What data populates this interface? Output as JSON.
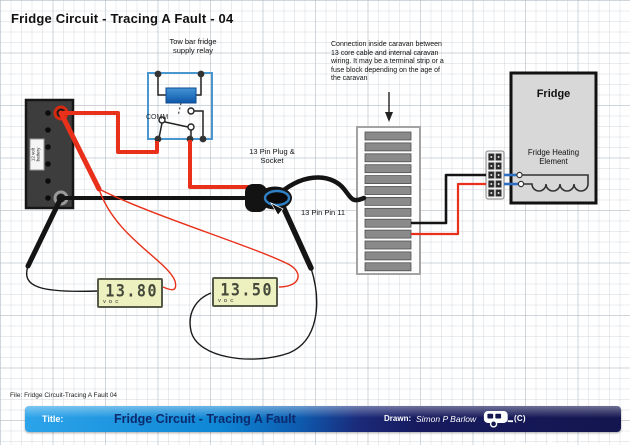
{
  "diagram": {
    "title": "Fridge Circuit - Tracing A Fault - 04",
    "relay_label": "Tow bar fridge\nsupply relay",
    "relay_comm": "COMM",
    "battery_label": "12 volt\nbattery",
    "note": "Connection inside caravan between\n13 core cable and internal caravan\nwiring. It may be a terminal strip or a\nfuse block depending on the age of\nthe caravan",
    "plug_label": "13 Pin Plug &\nSocket",
    "pin11_label": "13 Pin Pin 11",
    "fridge": {
      "title": "Fridge",
      "element_label": "Fridge Heating Element"
    },
    "meters": [
      {
        "name": "multimeter-1",
        "value": "13.80",
        "unit": "V",
        "mode": "DC"
      },
      {
        "name": "multimeter-2",
        "value": "13.50",
        "unit": "V",
        "mode": "DC"
      }
    ]
  },
  "footer": {
    "file_line": "File: Fridge Circuit-Tracing A Fault 04",
    "title_label": "Title:",
    "title": "Fridge Circuit - Tracing A Fault",
    "drawn_label": "Drawn:",
    "drawn_by": "Simon P Barlow",
    "copyright": "(C) CaravanChronicles.com",
    "caravan_icon": "caravan-icon"
  },
  "colors": {
    "wire_red": "#e8301a",
    "wire_black": "#141414",
    "wire_blue": "#2f6fc1",
    "relay_outline": "#4a97cf",
    "coil_blue": "#1668bf",
    "lcd_bg": "#ecf1bf",
    "bar_blue": "#1286d6",
    "bar_navy": "#181a62"
  }
}
